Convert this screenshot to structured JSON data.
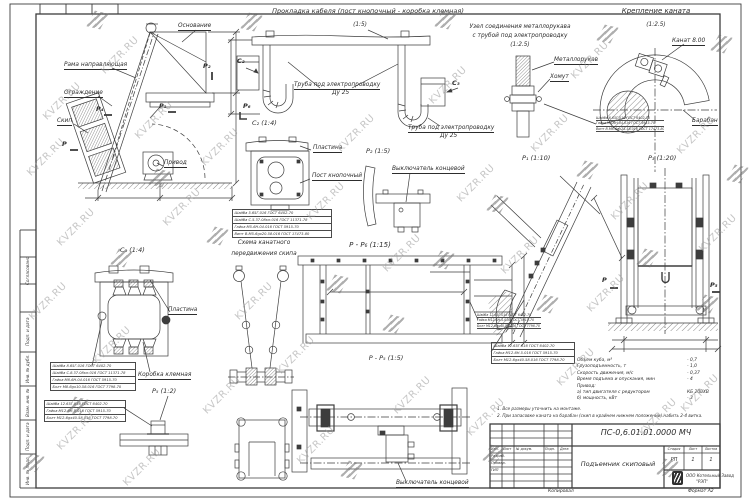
{
  "watermark": {
    "text": "KVZR.RU"
  },
  "sheet": {
    "copied": "Копировал",
    "format": "Формат А2",
    "side_labels": [
      "Согласовано",
      "Подп. и дата",
      "Инв. № дубл.",
      "Взам. инв. №",
      "Подп. и дата",
      "Инв. № подл."
    ]
  },
  "main_view": {
    "base": "Основание",
    "guide_frame": "Рама направляющая",
    "fence": "Ограждение",
    "skip": "Скип",
    "drive": "Привод",
    "marker_p": "P",
    "marker_p1": "P₁",
    "marker_p2": "P₂",
    "marker_p4": "P₄"
  },
  "cable_view": {
    "title": "Прокладка кабеля (пост кнопочный - коробка клемная)",
    "scale": "(1:5)",
    "tube_label": "Труба под электропроводку",
    "tube_dn": "Ду 25",
    "marker_c2": "C₂",
    "marker_c3": "C₃",
    "marker_p6": "P₆"
  },
  "sleeve_node": {
    "title_line1": "Узел соединения металлорукава",
    "title_line2": "с трубой под электропроводку",
    "scale": "(1:2.5)",
    "hose_label": "Металлорукав",
    "clamp_label": "Хомут"
  },
  "rope_mount": {
    "title": "Крепление каната",
    "scale": "(1:2.5)",
    "rope_label": "Канат 8.00",
    "drum_label": "Барабан"
  },
  "post_detail": {
    "title": "C₂ (1:4)",
    "plate_label": "Пластина",
    "post_label": "Пост кнопочный"
  },
  "switch_detail": {
    "title": "P₂ (1:5)",
    "switch_label": "Выключатель концевой"
  },
  "p1_detail": {
    "title": "P₁ (1:10)"
  },
  "p3_view": {
    "title": "P₃ (1:20)",
    "marker_p": "P",
    "marker_p5": "P₅"
  },
  "box_detail": {
    "title": "C₃ (1:4)",
    "plate_label": "Пластина",
    "box_label": "Коробка клемная"
  },
  "p5_detail": {
    "title": "P₅ (1:2)"
  },
  "rope_scheme": {
    "title_line1": "Схема канатного",
    "title_line2": "передвижения скипа"
  },
  "pp6_view": {
    "title": "P - P₆ (1:15)"
  },
  "pp5_view": {
    "title": "P - P₅ (1:5)",
    "switch_label": "Выключатель концевой"
  },
  "fasteners": {
    "a": [
      "Шайба 5.65Г.016 ГОСТ 6402-70",
      "Шайба С.5.37.08кп.016 ГОСТ 11371-78",
      "Гайка М5-6Н.04.016 ГОСТ 5915-70",
      "Винт В.М5-6gх20.58.016 ГОСТ 17473-80"
    ],
    "b": [
      "Шайба 6.65Г.016 ГОСТ 6402-70",
      "Гайка М6-6Н.04.016 ГОСТ 5915-70",
      "Винт В.М6-6gх25.58.016 ГОСТ 17473-80"
    ],
    "c": [
      "Шайба 8.65Г.016 ГОСТ 6402-70",
      "Шайба С.8.37.08кп.016 ГОСТ 11371-78",
      "Гайка М8-6Н.04.016 ГОСТ 5915-70",
      "Болт М8-6gх10.58.016 ГОСТ 7798-70"
    ],
    "d": [
      "Шайба 12.65Г.016 ГОСТ 6402-70",
      "Гайка М12-6Н.5.016 ГОСТ 5915-70",
      "Болт М12-6gх40.58.016 ГОСТ 7798-70"
    ],
    "e": [
      "Шайба 12.65Г.016 ГОСТ 6402-70",
      "Гайка М12-6Н.5.016 ГОСТ 5915-70",
      "Болт М12-6gх40.58.016 ГОСТ 7798-70"
    ],
    "f": [
      "Шайба 12.65Г.016 ГОСТ 6402-70",
      "Гайка М12-6Н.5.016 ГОСТ 5915-70",
      "Болт М12-6gх40.58.016 ГОСТ 7798-70"
    ]
  },
  "specs": {
    "rows": [
      {
        "label": "Объем куба, м³",
        "value": "- 0,7"
      },
      {
        "label": "Грузоподъемность, т",
        "value": "- 1,0"
      },
      {
        "label": "Скорость движения, м/с",
        "value": "- 0,37"
      },
      {
        "label": "Время подъема и опускания, мин",
        "value": "- 4"
      },
      {
        "label": "Привод:",
        "value": ""
      },
      {
        "label": "а) тип двигателя с редуктором",
        "value": "КБ 200ХВ"
      },
      {
        "label": "б) мощность, кВт",
        "value": "- 3"
      }
    ]
  },
  "notes": [
    "1. Все размеры уточнить на монтаже.",
    "2. При запасовке каната на барабан (скип в крайнем нижнем положении) набить 2-4 витка."
  ],
  "title_block": {
    "doc_number": "ПС-0,6.01.01.0000 МЧ",
    "doc_title": "Подъемник скиповый",
    "columns": [
      "Изм.",
      "Лист",
      "№ докум.",
      "Подп.",
      "Дата"
    ],
    "rows": [
      "Разраб.",
      "Провер.",
      "ГИП"
    ],
    "stage_label": "Стадия",
    "sheet_label": "Лист",
    "sheets_label": "Листов",
    "stage": "РП",
    "sheet": "1",
    "sheets": "1",
    "company1": "ООО Котельный Завод",
    "company2": "\"РЭП\""
  }
}
